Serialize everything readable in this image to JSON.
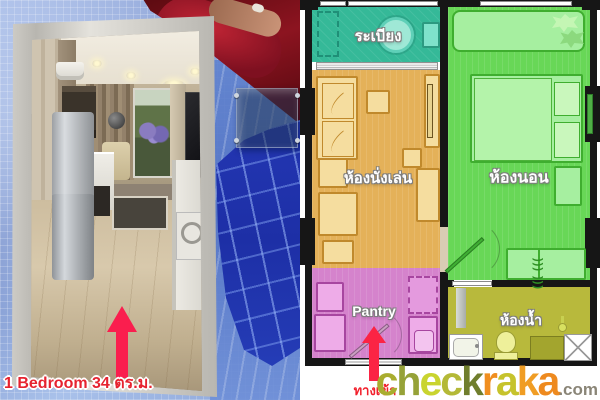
{
  "photo": {
    "caption": "1 Bedroom 34 ตร.ม."
  },
  "floor_plan": {
    "rooms": [
      {
        "id": "balcony",
        "label": "ระเบียง",
        "color": "#35b998"
      },
      {
        "id": "living-room",
        "label": "ห้องนั่งเล่น",
        "color": "#e4b159"
      },
      {
        "id": "bedroom",
        "label": "ห้องนอน",
        "color": "#68d757"
      },
      {
        "id": "pantry",
        "label": "Pantry",
        "color": "#d583cc"
      },
      {
        "id": "bathroom",
        "label": "ห้องน้ำ",
        "color": "#b8b93c"
      }
    ],
    "entrance_label": "ทางเข้า",
    "wardrobe_hanger_glyphs": ")))  )))"
  },
  "watermark": {
    "letters": [
      {
        "ch": "c",
        "color": "#a9ad2f"
      },
      {
        "ch": "h",
        "color": "#96a238"
      },
      {
        "ch": "e",
        "color": "#c9d42f"
      },
      {
        "ch": "c",
        "color": "#b4b937"
      },
      {
        "ch": "k",
        "color": "#707e2d"
      },
      {
        "ch": "r",
        "color": "#f08e20"
      },
      {
        "ch": "a",
        "color": "#c6c32c"
      },
      {
        "ch": "k",
        "color": "#f09d24"
      },
      {
        "ch": "a",
        "color": "#ee8a1f"
      }
    ],
    "suffix": ".com"
  }
}
